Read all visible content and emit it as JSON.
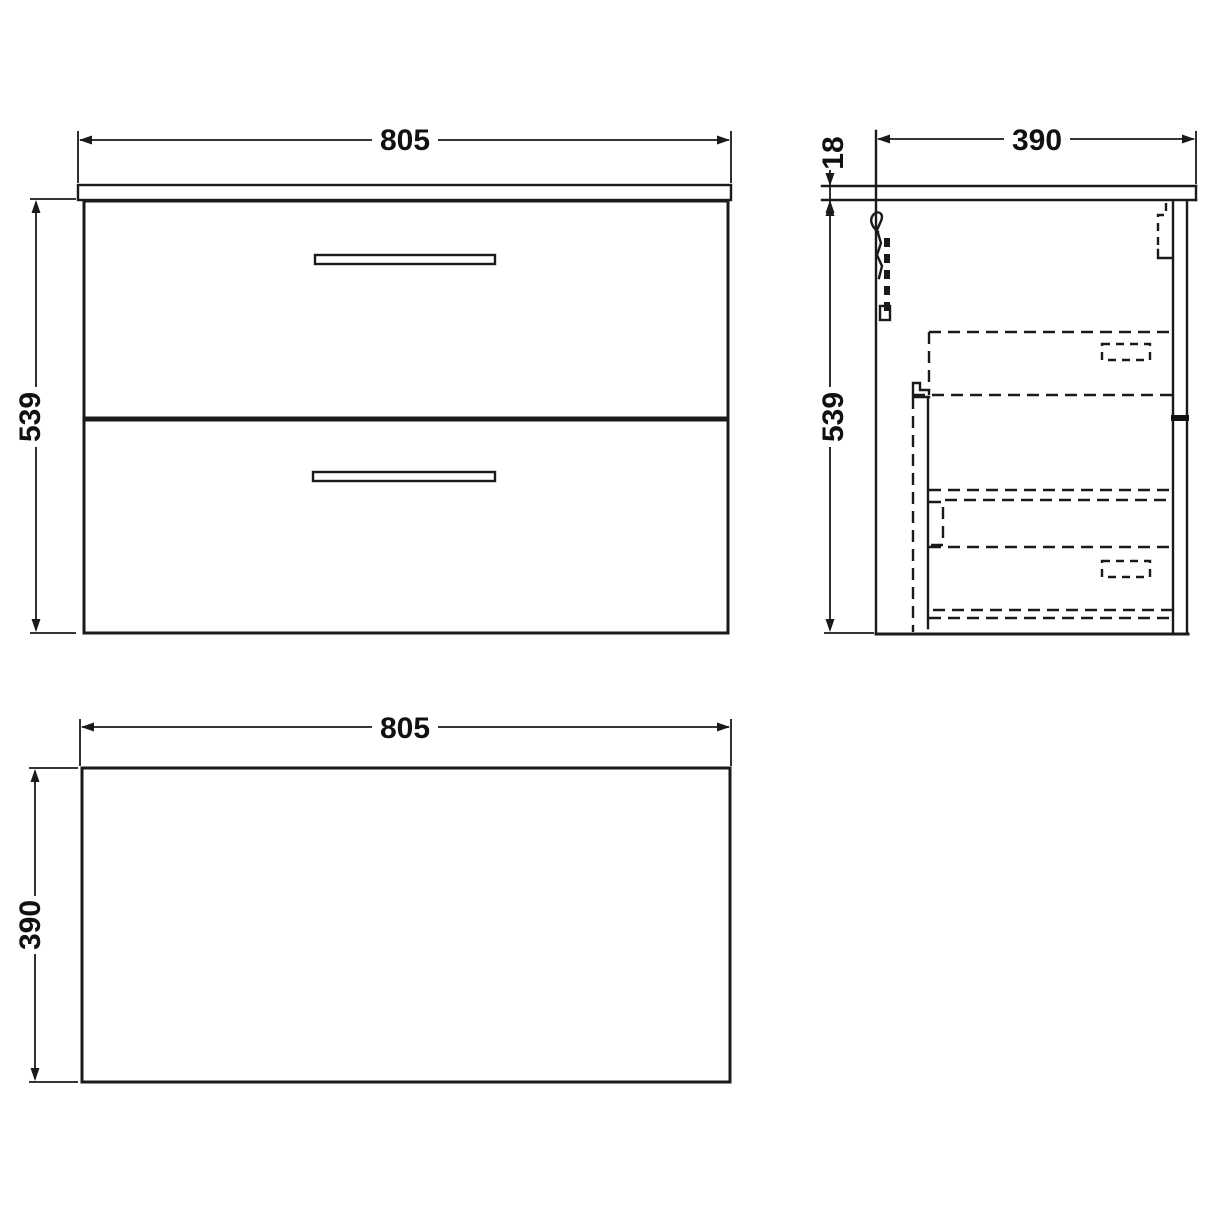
{
  "page": {
    "background": "#ffffff"
  },
  "drawing": {
    "type": "technical-dimension-drawing",
    "subject": "wall-hung two-drawer vanity unit with countertop",
    "line_color": "#1a1a1a",
    "views": {
      "front": {
        "name": "front-view",
        "width_dim": "805",
        "height_dim": "539"
      },
      "side": {
        "name": "side-view",
        "depth_dim": "390",
        "countertop_thickness_dim": "18",
        "height_dim": "539"
      },
      "plan": {
        "name": "plan-view",
        "width_dim": "805",
        "depth_dim": "390"
      }
    }
  }
}
